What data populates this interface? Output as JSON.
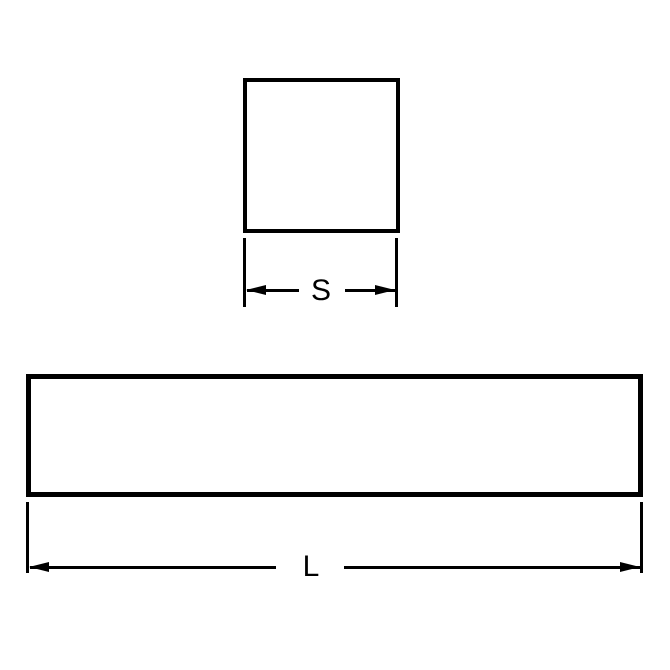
{
  "drawing": {
    "colors": {
      "line": "#000000",
      "background": "#ffffff"
    },
    "views": {
      "cross_section": {
        "shape": "square",
        "dimension": {
          "label": "S"
        }
      },
      "side_view": {
        "shape": "rectangle",
        "dimension": {
          "label": "L"
        }
      }
    }
  }
}
